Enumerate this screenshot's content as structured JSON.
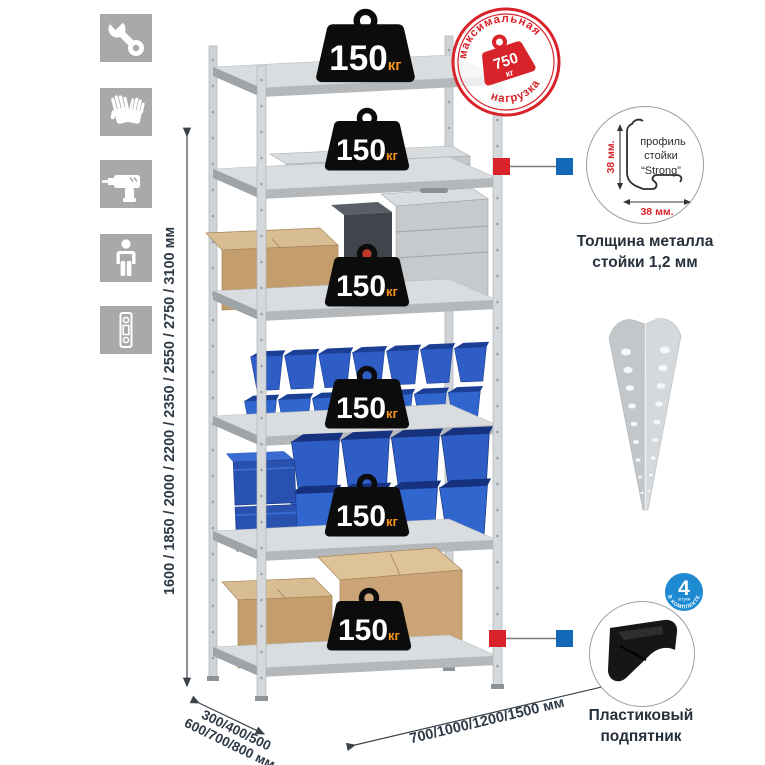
{
  "page": {
    "background": "#ffffff"
  },
  "left_toolbar": {
    "icons": [
      "wrench",
      "gloves",
      "drill",
      "person",
      "level"
    ]
  },
  "dimensions": {
    "height_label": "1600 / 1850 / 2000 / 2200 / 2350 / 2550 / 2750 / 3100 мм",
    "depth_label_line1": "300/400/500",
    "depth_label_line2": "600/700/800 мм",
    "width_label": "700/1000/1200/1500 мм"
  },
  "rack": {
    "shelves": [
      {
        "load": "150",
        "unit": "кг"
      },
      {
        "load": "150",
        "unit": "кг"
      },
      {
        "load": "150",
        "unit": "кг"
      },
      {
        "load": "150",
        "unit": "кг"
      },
      {
        "load": "150",
        "unit": "кг"
      },
      {
        "load": "150",
        "unit": "кг"
      }
    ]
  },
  "max_load_stamp": {
    "arc_top": "максимальная",
    "arc_bottom": "нагрузка",
    "value": "750",
    "unit": "кг",
    "color": "#d8232a"
  },
  "profile_detail": {
    "label_line1": "профиль",
    "label_line2": "стойки",
    "label_line3": "“Strong”",
    "vertical_dim": "38 мм.",
    "horizontal_dim": "38 мм.",
    "caption_line1": "Толщина металла",
    "caption_line2": "стойки 1,2 мм"
  },
  "foot_detail": {
    "badge_value": "4",
    "badge_small_text": "штуки",
    "badge_arc_text": "в комплекте",
    "badge_color": "#1d8ad2",
    "caption_line1": "Пластиковый",
    "caption_line2": "подпятник"
  },
  "colors": {
    "accent_red": "#d8232a",
    "connector_blue": "#1468b8",
    "bin_blue": "#2e5ec5",
    "cardboard": "#c49d6d",
    "metal_gray": "#d6d9db",
    "icon_gray": "#a7a9ab",
    "text_dark": "#2e3a46",
    "badge_unit_orange": "#f7941d"
  }
}
